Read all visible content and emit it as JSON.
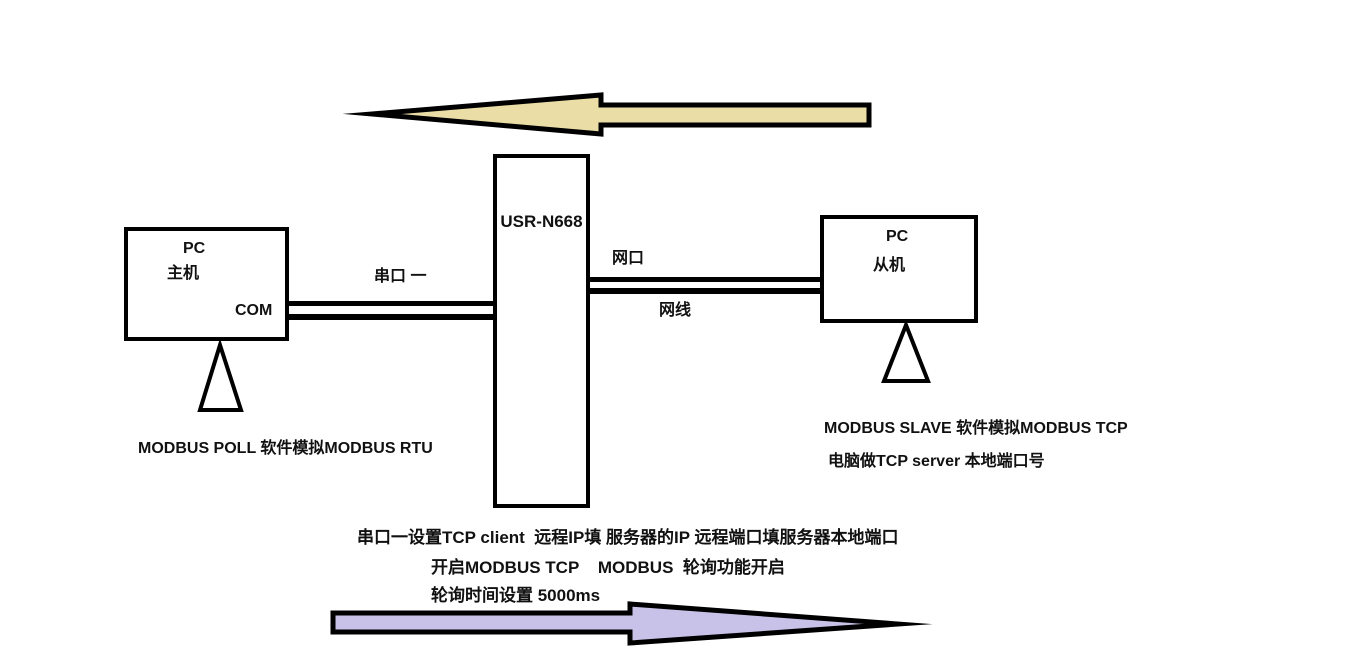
{
  "colors": {
    "top_arrow_fill": "#EADEA6",
    "bottom_arrow_fill": "#C8C2E8",
    "outline": "#000000"
  },
  "device": {
    "label": "USR-N668"
  },
  "left_pc": {
    "title": "PC",
    "role": "主机",
    "port": "COM"
  },
  "right_pc": {
    "title": "PC",
    "role": "从机"
  },
  "links": {
    "serial_label": "串口 一",
    "net_port_label": "网口",
    "net_cable_label": "网线"
  },
  "notes": {
    "left": "MODBUS POLL 软件模拟MODBUS RTU",
    "right1": "MODBUS SLAVE 软件模拟MODBUS TCP",
    "right2": "电脑做TCP server 本地端口号",
    "bottom": [
      "串口一设置TCP client  远程IP填 服务器的IP 远程端口填服务器本地端口",
      "开启MODBUS TCP    MODBUS  轮询功能开启",
      "轮询时间设置 5000ms"
    ]
  },
  "arrows": {
    "top_direction": "left",
    "bottom_direction": "right"
  }
}
